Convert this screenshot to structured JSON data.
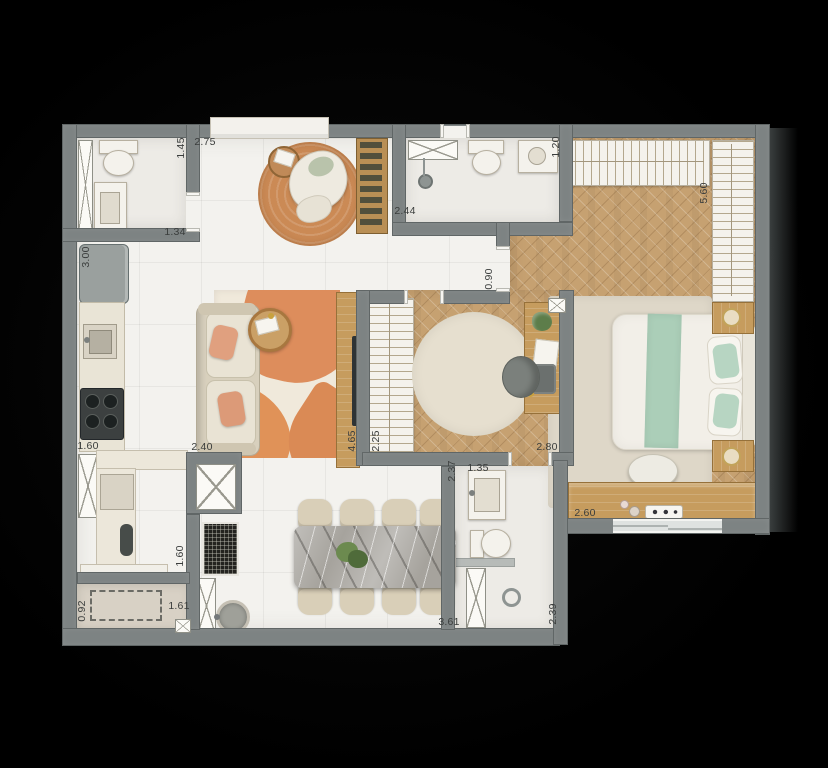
{
  "plan_type": "apartment-floor-plan",
  "colors": {
    "background": "#000000",
    "wall": "#7d8383",
    "floor_tile": "#f3f2ee",
    "bath_floor": "#edebe6",
    "wood_floor": "#c6a171",
    "wood_furniture": "#c69c5e",
    "rug_orange": "#cb8a55",
    "area_rug_cream": "#f0e9db",
    "area_rug_orange": "#dd8d5c",
    "sofa_beige": "#d8d0bd",
    "pillow_salmon": "#e0a07f",
    "bed_green": "#abceb8",
    "bed_white": "#f2efe8",
    "marble": "#a6a39d",
    "chair_beige": "#d9cfb8",
    "label_text": "#3a3d3c"
  },
  "dimension_labels": [
    {
      "value": "2.75",
      "vertical": false
    },
    {
      "value": "1.45",
      "vertical": true
    },
    {
      "value": "1.34",
      "vertical": false
    },
    {
      "value": "2.44",
      "vertical": false
    },
    {
      "value": "1.20",
      "vertical": true
    },
    {
      "value": "5.60",
      "vertical": true
    },
    {
      "value": "3.00",
      "vertical": true
    },
    {
      "value": "0.90",
      "vertical": true
    },
    {
      "value": "1.60",
      "vertical": false
    },
    {
      "value": "2.40",
      "vertical": false
    },
    {
      "value": "4.65",
      "vertical": true
    },
    {
      "value": "2.25",
      "vertical": true
    },
    {
      "value": "2.80",
      "vertical": false
    },
    {
      "value": "1.35",
      "vertical": false
    },
    {
      "value": "2.37",
      "vertical": true
    },
    {
      "value": "2.60",
      "vertical": false
    },
    {
      "value": "1.60",
      "vertical": true
    },
    {
      "value": "0.92",
      "vertical": true
    },
    {
      "value": "1.61",
      "vertical": false
    },
    {
      "value": "3.61",
      "vertical": false
    },
    {
      "value": "2.39",
      "vertical": true
    }
  ],
  "rooms": {
    "bathroom_top_left": {
      "furniture": [
        "toilet",
        "vanity-sink",
        "linen-cabinet"
      ]
    },
    "entry_living": {
      "furniture": [
        "entry-console",
        "round-rug",
        "lounge-chair",
        "side-table",
        "sofa",
        "throw-pillows",
        "coffee-table",
        "area-rug",
        "tv-panel",
        "tv",
        "wine-rack"
      ]
    },
    "kitchen": {
      "furniture": [
        "refrigerator",
        "countertop",
        "sink",
        "cooktop"
      ]
    },
    "bathroom_top_middle": {
      "furniture": [
        "shower-enclosure",
        "shower-head",
        "toilet",
        "vanity-sink"
      ]
    },
    "walk_in_closet": {
      "furniture": [
        "wardrobe-top",
        "wardrobe-right"
      ]
    },
    "master_bedroom": {
      "furniture": [
        "area-rug",
        "double-bed",
        "green-runner",
        "pillows",
        "headboard",
        "nightstand-top",
        "nightstand-bottom",
        "table-lamps",
        "bench",
        "dresser",
        "perfume-bottles",
        "tray",
        "sliding-window"
      ]
    },
    "bedroom_2": {
      "furniture": [
        "wardrobe",
        "round-rug",
        "desk",
        "desk-chair",
        "laptop",
        "plant",
        "papers"
      ]
    },
    "bathroom_bottom_right": {
      "furniture": [
        "vanity-sink",
        "toilet",
        "shower-partition",
        "floor-drain",
        "linen-cabinet"
      ]
    },
    "dining": {
      "furniture": [
        "marble-table",
        "dining-chairs-x8",
        "plant-centerpiece",
        "ac-grille"
      ]
    },
    "laundry": {
      "furniture": [
        "tall-cabinet",
        "counter",
        "washer",
        "laundry-tub"
      ]
    },
    "balcony": {
      "furniture": [
        "dashed-projection",
        "counter-sill"
      ]
    }
  }
}
